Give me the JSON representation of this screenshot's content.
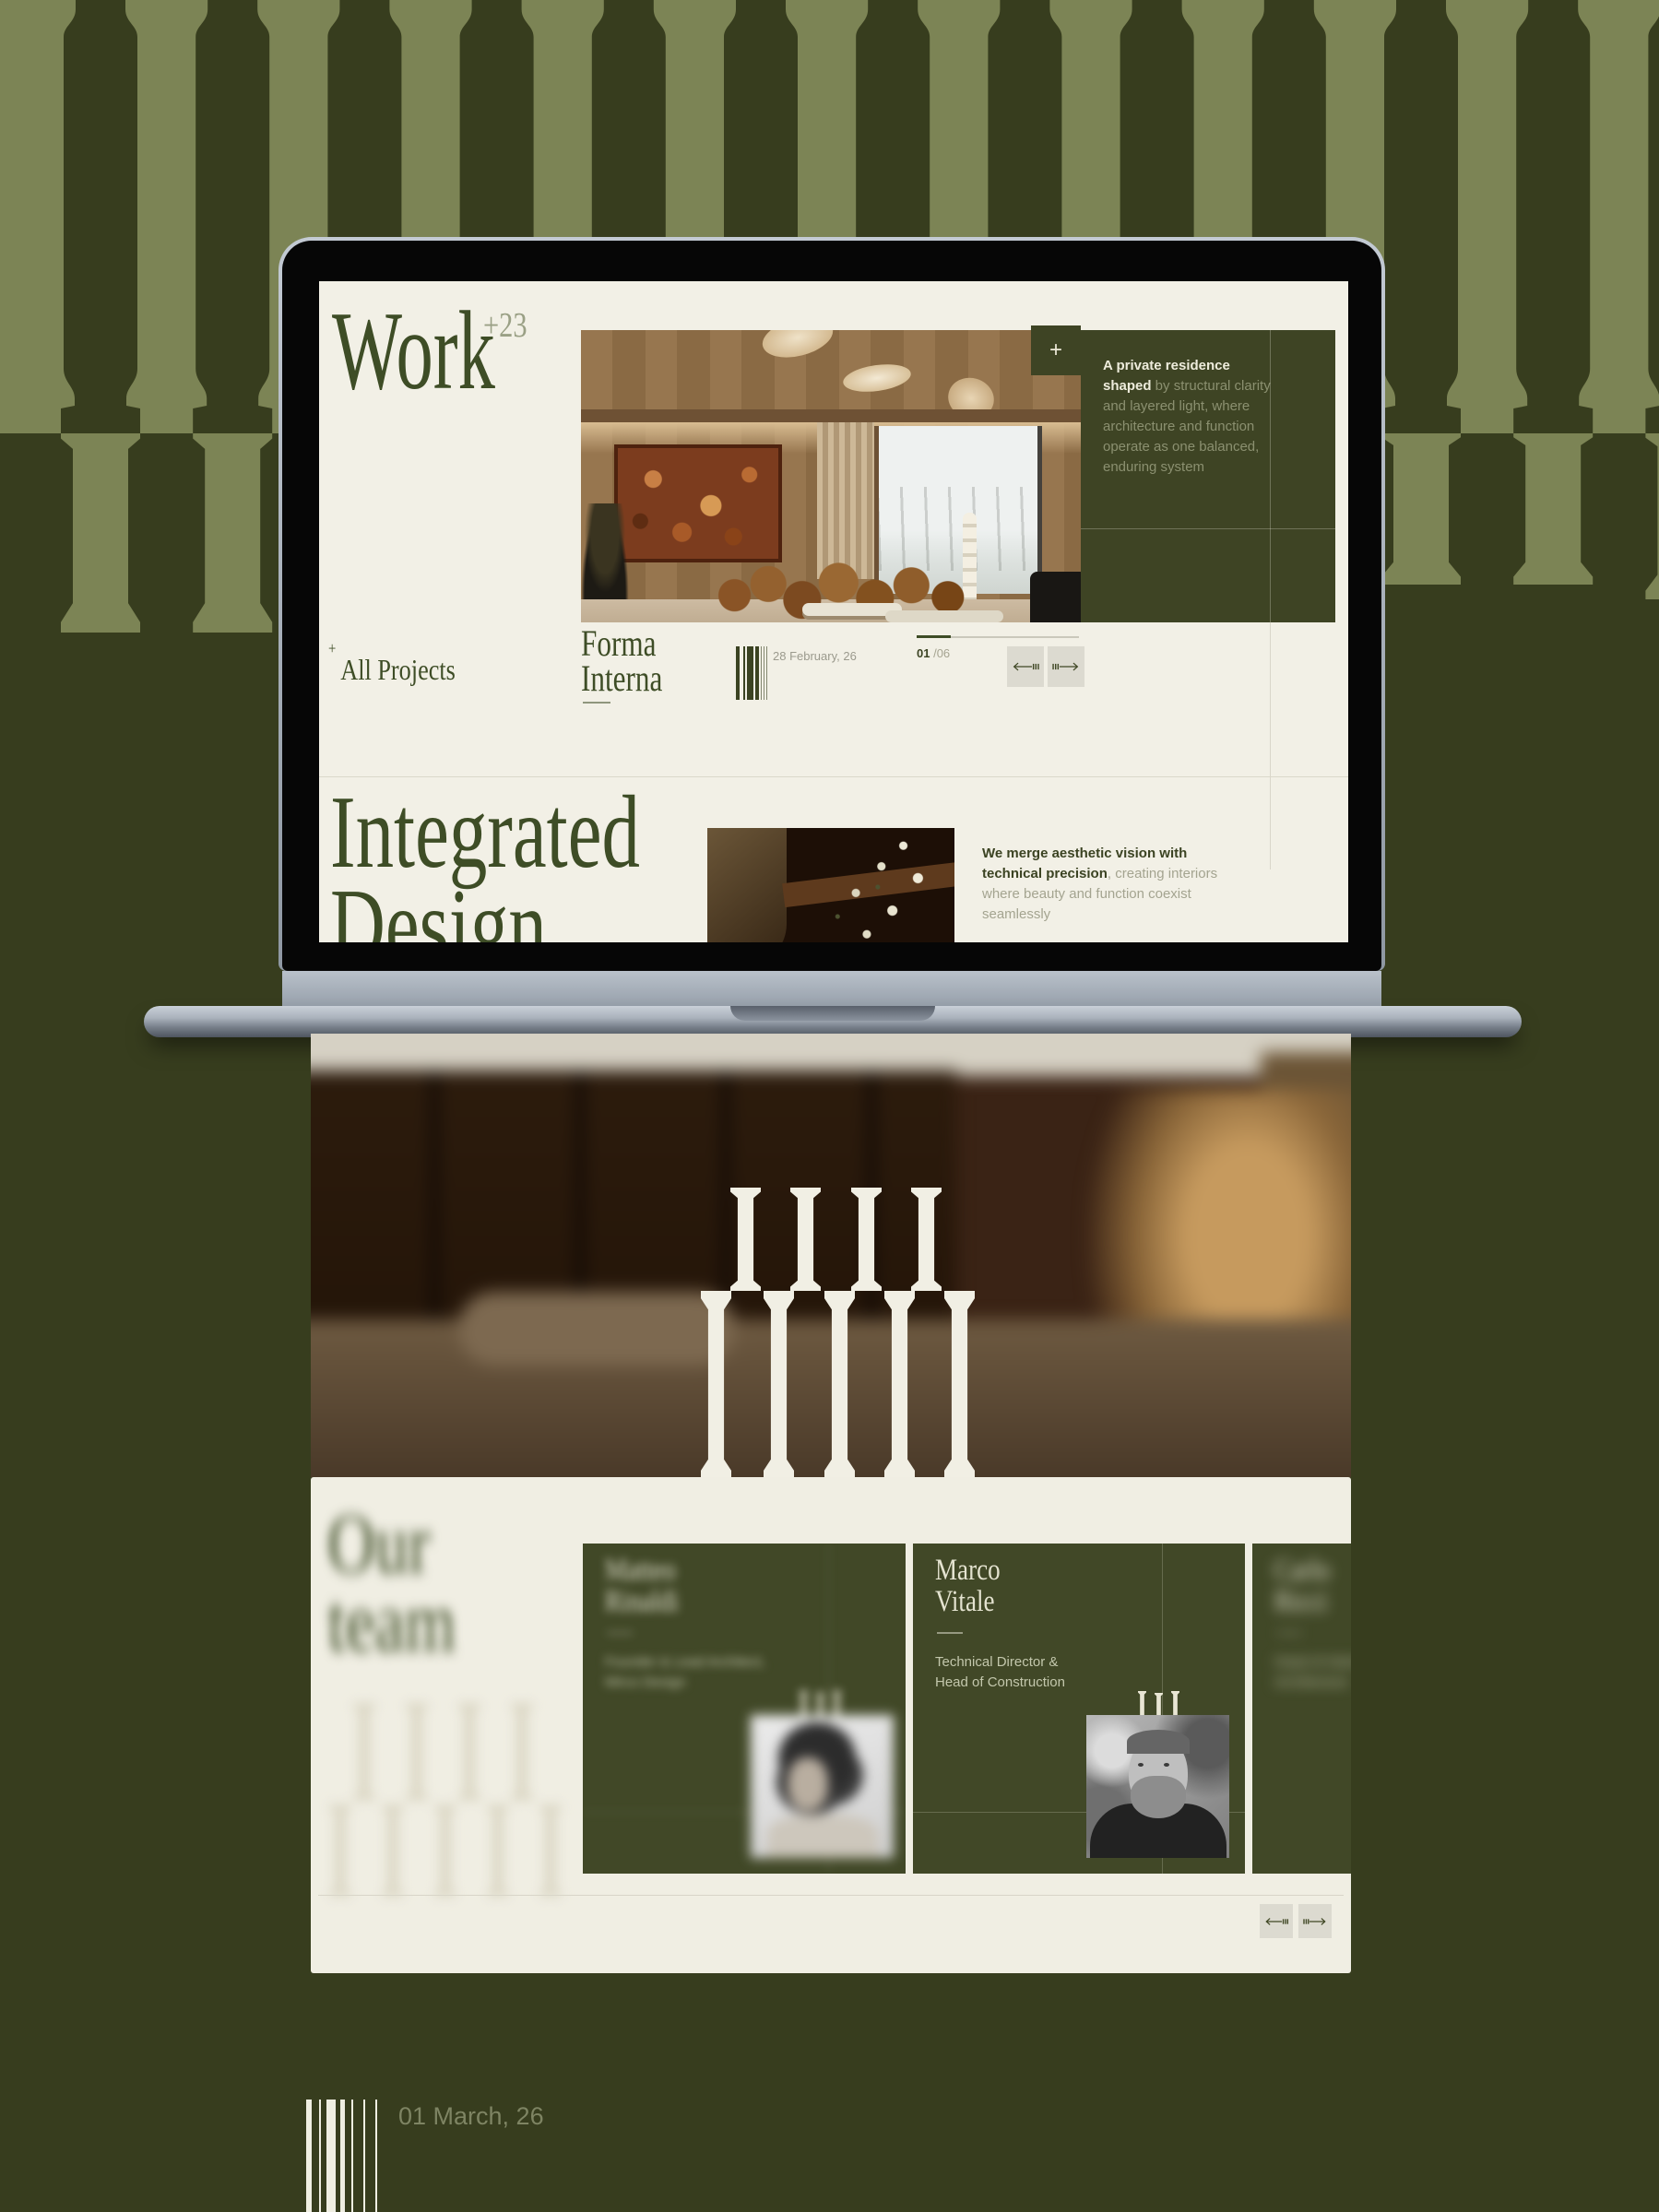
{
  "colors": {
    "poster_bg": "#373d1e",
    "pattern_light": "#7c8455",
    "screen_cream": "#f2f0e6",
    "accent_green": "#3e4d26",
    "panel_green": "#3e4424",
    "card_green": "#414827",
    "muted_on_green": "#8b9070",
    "muted_on_cream": "#9b9a8d",
    "button_bg": "#dcdad0"
  },
  "screen": {
    "work_title": "Work",
    "work_count": "+23",
    "all_projects_prefix": "+",
    "all_projects": "All Projects",
    "hero_plus": "+",
    "panel": {
      "lead": "A private residence shaped",
      "rest": " by structural clarity and layered light, where architecture and function operate as one balanced, enduring system"
    },
    "project": {
      "name_line1": "Forma",
      "name_line2": "Interna",
      "date": "28 February, 26",
      "counter_current": "01",
      "counter_total": "/06"
    },
    "integrated": {
      "title_line1": "Integrated",
      "title_line2": "Design",
      "lead": "We merge aesthetic vision with technical precision",
      "rest": ", creating interiors where beauty and function coexist seamlessly"
    }
  },
  "team": {
    "title_line1": "Our",
    "title_line2": "team",
    "members": [
      {
        "name_line1": "Matteo",
        "name_line2": "Rinaldi",
        "role_line1": "Founder & Lead Architect,",
        "role_line2": "Mirco Design"
      },
      {
        "name_line1": "Marco",
        "name_line2": "Vitale",
        "role_line1": "Technical Director &",
        "role_line2": "Head of Construction"
      },
      {
        "name_line1": "Carlo",
        "name_line2": "Ricci",
        "role_line1": "Head of Interior",
        "role_line2": "Architecture"
      }
    ]
  },
  "footer": {
    "date": "01 March, 26"
  }
}
